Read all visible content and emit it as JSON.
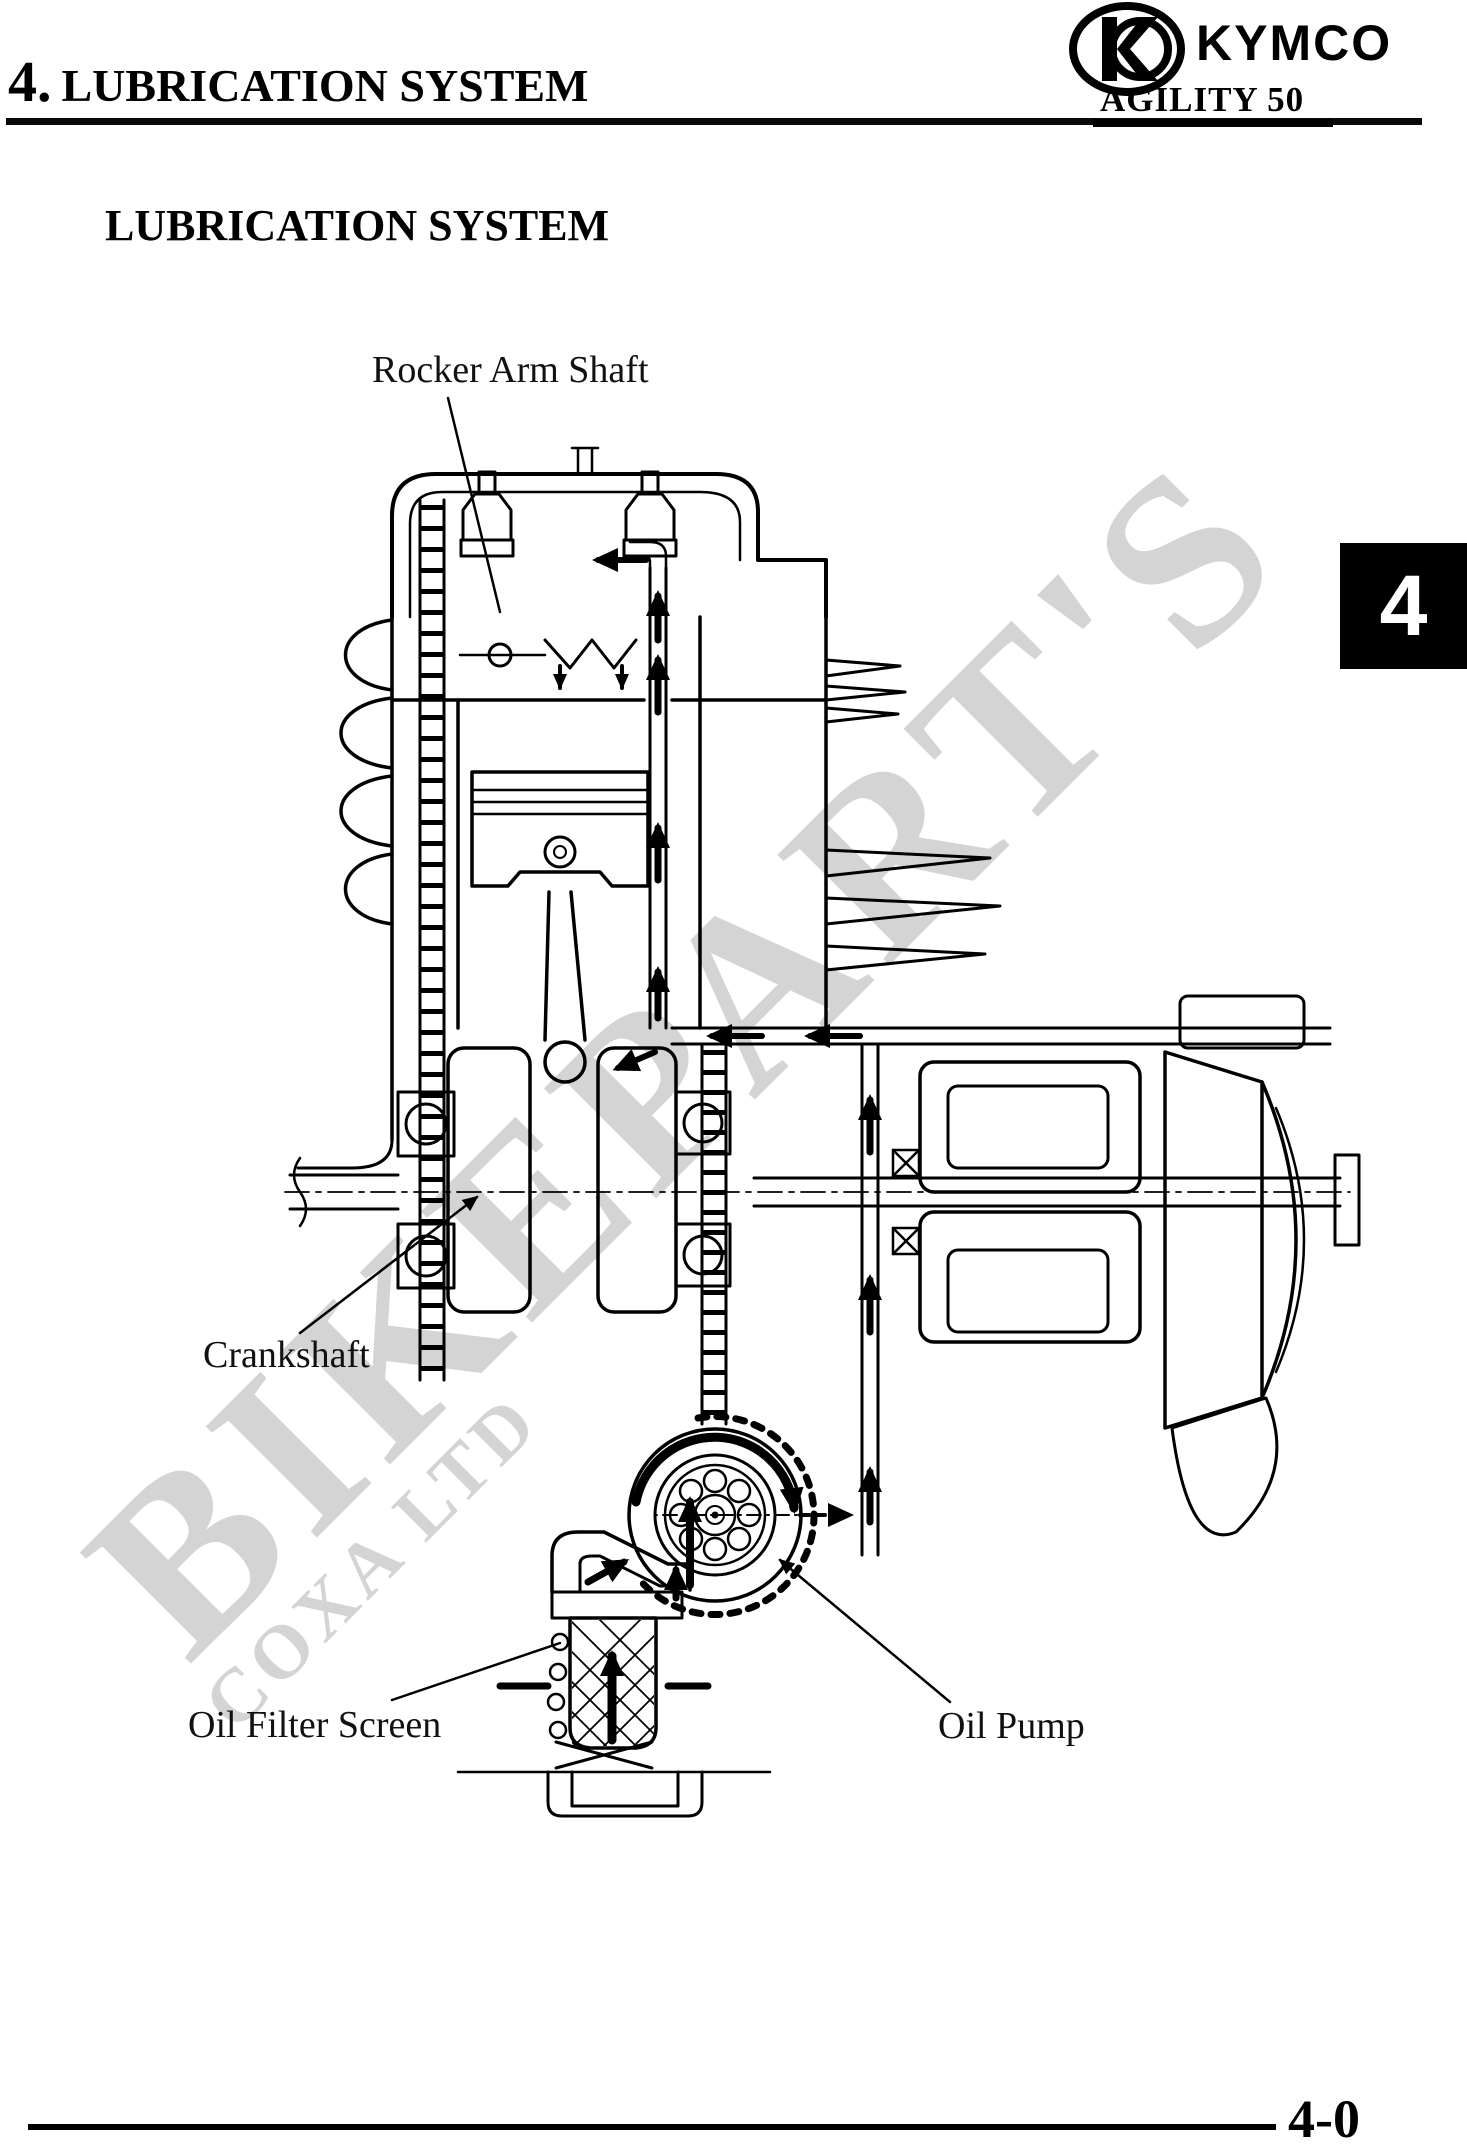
{
  "header": {
    "chapter_number": "4.",
    "chapter_title": "LUBRICATION SYSTEM",
    "brand": "KYMCO",
    "model": "AGILITY 50"
  },
  "section": {
    "title": "LUBRICATION SYSTEM"
  },
  "diagram": {
    "labels": {
      "rocker_arm_shaft": "Rocker Arm Shaft",
      "crankshaft": "Crankshaft",
      "oil_filter_screen": "Oil Filter Screen",
      "oil_pump": "Oil Pump"
    }
  },
  "side_tab": {
    "label": "4"
  },
  "footer": {
    "page_number": "4-0"
  },
  "watermark": {
    "primary": "BIKEPART'S",
    "secondary": "COXA LTD"
  },
  "colors": {
    "ink": "#000000",
    "paper": "#ffffff",
    "watermark": "#d4d4d4",
    "tab_bg": "#000000",
    "tab_text": "#ffffff"
  }
}
